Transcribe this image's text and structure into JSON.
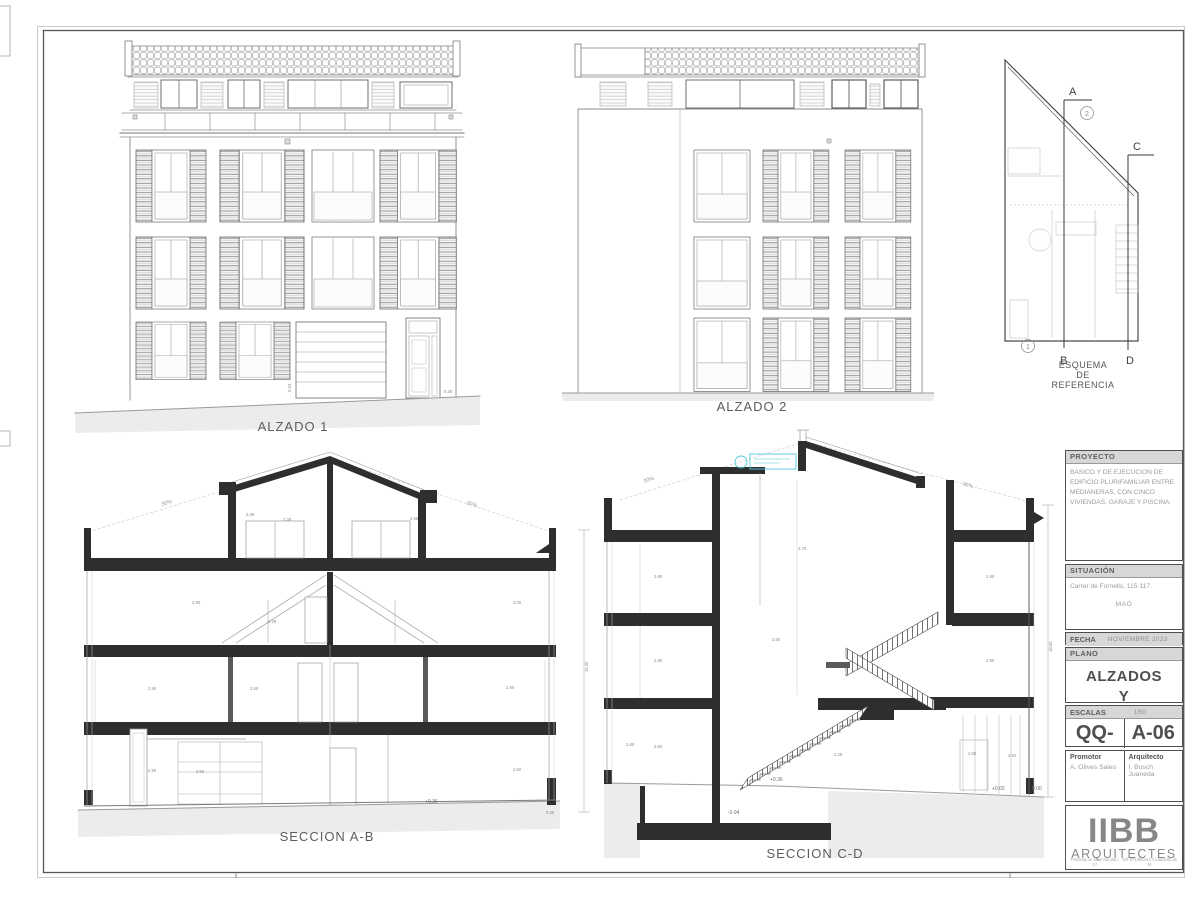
{
  "colors": {
    "ink": "#2e2e2e",
    "line_light": "#9a9a9a",
    "accent_cyan": "#4fc8dc",
    "ground_fill": "#ececec",
    "panel_gray": "#d7d7d7"
  },
  "title_block": {
    "proyecto_label": "PROYECTO",
    "proyecto_text": "BASICO Y DE EJECUCION DE EDIFICIO PLURIFAMILIAR ENTRE MEDIANERAS, CON CINCO VIVIENDAS, GARAJE Y PISCINA.",
    "situacion_label": "SITUACIÓN",
    "situacion_address": "Carrer de Fornells, 115-117.",
    "situacion_city": "MAÓ",
    "fecha_label": "FECHA",
    "fecha_value": "NOVIEMBRE  2023",
    "plano_label": "PLANO",
    "plano_line1": "ALZADOS",
    "plano_line2": "Y",
    "plano_line3": "SECCIONES",
    "escalas_label": "ESCALAS",
    "escalas_value": "1/50",
    "code_left": "QQ-40",
    "code_right": "A-06",
    "promotor_label": "Promotor",
    "promotor_value": "A. Olives Sales",
    "arquitecto_label": "Arquitecto",
    "arquitecto_value": "I. Bosch Juaneda",
    "logo_name": "IIBB",
    "logo_sub": "ARQUITECTES",
    "footer_left": "Passeig de Sant Nicolau, 17",
    "footer_right": "telf 971380443 Ciutadella de M."
  },
  "drawings": {
    "alzado1": {
      "label": "ALZADO 1",
      "dim_a": "0.60",
      "dim_b": "0.36"
    },
    "alzado2": {
      "label": "ALZADO 2"
    },
    "esquema": {
      "title_line1": "ESQUEMA",
      "title_line2": "DE",
      "title_line3": "REFERENCIA",
      "a": "A",
      "b": "B",
      "c": "C",
      "d": "D",
      "n1": "1",
      "n2": "2"
    },
    "ab": {
      "label": "SECCION A-B",
      "slope_l": "30%",
      "slope_r": "30%",
      "total": "16.00",
      "level": "+0.36",
      "step": "0.36",
      "dims": [
        "2.08",
        "2.38",
        "2.85",
        "2.90",
        "2.28",
        "3.00",
        "2.90",
        "2.50",
        "2.90",
        "2.90",
        "2.50",
        "2.50"
      ]
    },
    "cd": {
      "label": "SECCION C-D",
      "slope_l": "30%",
      "slope_r": "30%",
      "total": "18.00",
      "levels": [
        "+0.36",
        "-0.94",
        "+0.02",
        "0.00"
      ],
      "dims": [
        "4.70",
        "2.90",
        "2.90",
        "2.90",
        "3.50",
        "2.90",
        "2.50",
        "2.80",
        "2.29",
        "2.86",
        "2.84"
      ]
    }
  }
}
